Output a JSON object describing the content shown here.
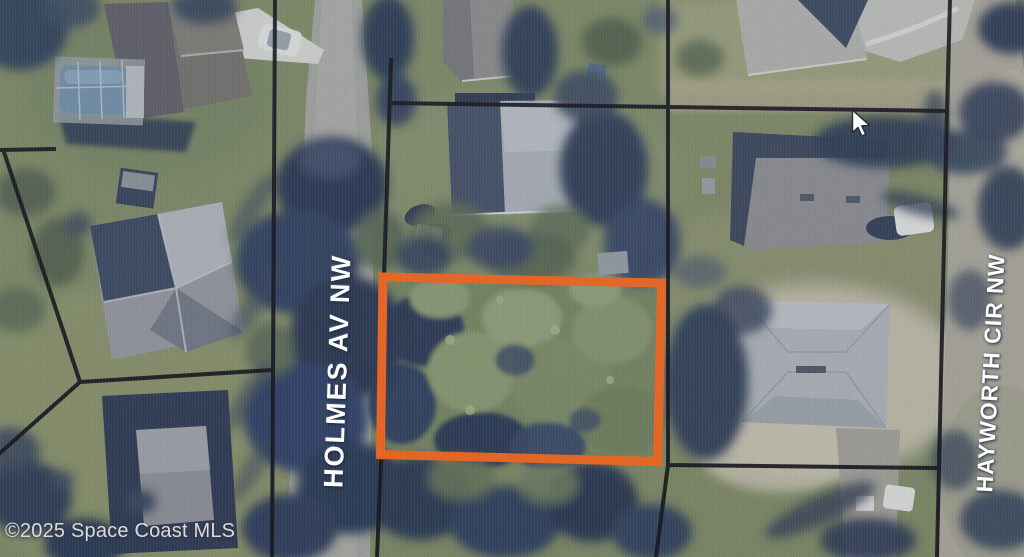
{
  "map": {
    "view": "aerial-parcel-view",
    "street_labels": [
      {
        "id": "holmes",
        "text": "HOLMES AV NW",
        "orientation": "vertical"
      },
      {
        "id": "hayworth",
        "text": "HAYWORTH CIR NW",
        "orientation": "vertical"
      }
    ],
    "attribution": "©2025 Space Coast MLS",
    "highlighted_parcel": {
      "outline_color": "#e4601c"
    },
    "colors": {
      "boundary_lines": "#12121a",
      "street_label_text": "#ffffff",
      "attribution_text": "#dcdcd8"
    },
    "cursor_icon": "arrow-pointer"
  }
}
